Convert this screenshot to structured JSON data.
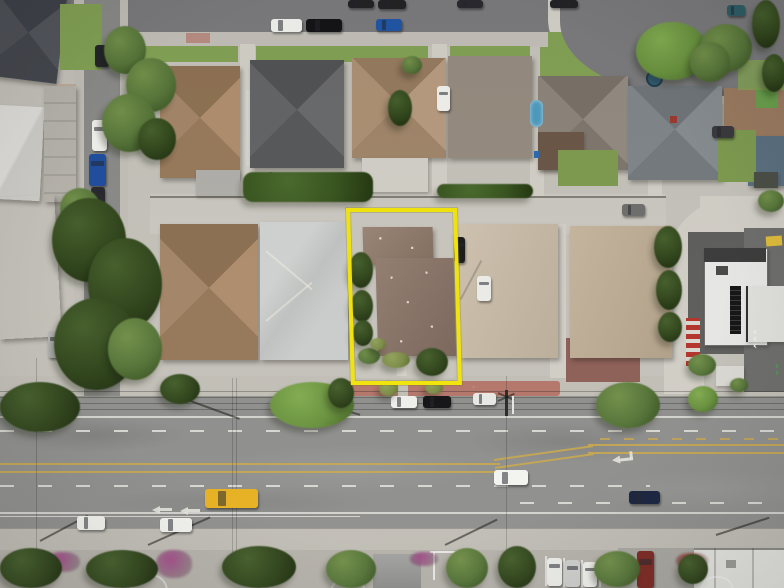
{
  "scene": {
    "description": "Aerial drone photograph of a suburban residential block; a single-family parcel with a brown roof is outlined with a bright yellow rectangle; a wide four-lane boulevard with double yellow centerlines runs along the bottom, a smaller residential street runs along the top, and a side street with parked cars runs down the left edge.",
    "highlight_label": "subject-parcel-outline",
    "roads": {
      "top": "residential street with curb-parked cars",
      "left": "side street with parallel-parked cars",
      "bottom": "four-lane boulevard with center turn lane",
      "right": "rear alley curving around a commercial building"
    }
  },
  "palette": {
    "concrete": "#c6c3bb",
    "concrete_light": "#d3d0c8",
    "sidewalk": "#c3c0b8",
    "asphalt": "#90908e",
    "asphalt_dark": "#7b7b7d",
    "asphalt_lot": "#6e6e6c",
    "roof_slate": "#4c4f55",
    "roof_brown": "#a8896b",
    "roof_brown2": "#9b7b60",
    "roof_charcoal": "#616264",
    "roof_tan": "#b1957a",
    "roof_greige": "#978c80",
    "roof_warmgray": "#8d847b",
    "roof_shingle": "#80868a",
    "roof_lightgray": "#c9cbca",
    "roof_subject": "#8d7668",
    "roof_garage": "#937c6c",
    "roof_beige1": "#cbbda8",
    "roof_beige2": "#c2b096",
    "roof_white": "#e9e9e7",
    "grass": "#84a355",
    "lawn": "#7f9c50",
    "turf": "#69a04c",
    "lane_white": "#e6e4de",
    "lane_yellow": "#c9a94e",
    "highlight_yellow": "#f4e60b",
    "brick": "#b5786c",
    "maroon": "#8e6058",
    "pool": "#4f9cc0",
    "magenta": "#a23e86",
    "flower_red": "#9c2c24"
  },
  "vehicles": [
    {
      "x": 348,
      "y": 0,
      "w": 26,
      "h": 8,
      "c": "#232326",
      "d": "h",
      "n": "parked-car"
    },
    {
      "x": 378,
      "y": 0,
      "w": 28,
      "h": 9,
      "c": "#232326",
      "d": "h",
      "n": "parked-car"
    },
    {
      "x": 457,
      "y": 0,
      "w": 26,
      "h": 8,
      "c": "#2a2a2e",
      "d": "h",
      "n": "parked-car"
    },
    {
      "x": 550,
      "y": 0,
      "w": 28,
      "h": 8,
      "c": "#232326",
      "d": "h",
      "n": "parked-car"
    },
    {
      "x": 727,
      "y": 5,
      "w": 18,
      "h": 11,
      "c": "#2e5e66",
      "d": "h",
      "n": "parked-car"
    },
    {
      "x": 271,
      "y": 19,
      "w": 31,
      "h": 13,
      "c": "#f1f1ed",
      "d": "h",
      "n": "parked-car"
    },
    {
      "x": 306,
      "y": 19,
      "w": 36,
      "h": 13,
      "c": "#141417",
      "d": "h",
      "n": "parked-car"
    },
    {
      "x": 376,
      "y": 19,
      "w": 26,
      "h": 12,
      "c": "#2157a6",
      "d": "h",
      "n": "parked-truck"
    },
    {
      "x": 95,
      "y": 45,
      "w": 14,
      "h": 22,
      "c": "#26262a",
      "d": "v",
      "n": "parked-car"
    },
    {
      "x": 92,
      "y": 120,
      "w": 15,
      "h": 31,
      "c": "#f1f1ed",
      "d": "v",
      "n": "parked-car"
    },
    {
      "x": 89,
      "y": 154,
      "w": 17,
      "h": 32,
      "c": "#1f4fa0",
      "d": "v",
      "n": "parked-car"
    },
    {
      "x": 91,
      "y": 187,
      "w": 14,
      "h": 17,
      "c": "#2a2a2e",
      "d": "v",
      "n": "parked-car"
    },
    {
      "x": 48,
      "y": 331,
      "w": 13,
      "h": 27,
      "c": "#b9b9b7",
      "d": "v",
      "n": "parked-car"
    },
    {
      "x": 437,
      "y": 86,
      "w": 13,
      "h": 25,
      "c": "#f1f1ed",
      "d": "v",
      "n": "driveway-car"
    },
    {
      "x": 477,
      "y": 276,
      "w": 14,
      "h": 25,
      "c": "#eeeeea",
      "d": "v",
      "n": "driveway-car"
    },
    {
      "x": 454,
      "y": 237,
      "w": 11,
      "h": 26,
      "c": "#1a1a1d",
      "d": "v",
      "n": "driveway-car"
    },
    {
      "x": 622,
      "y": 204,
      "w": 23,
      "h": 12,
      "c": "#6f6f6d",
      "d": "h",
      "n": "alley-car"
    },
    {
      "x": 712,
      "y": 126,
      "w": 22,
      "h": 12,
      "c": "#3a3a3e",
      "d": "h",
      "n": "driveway-car"
    },
    {
      "x": 391,
      "y": 396,
      "w": 26,
      "h": 12,
      "c": "#f0f0ec",
      "d": "h",
      "n": "curb-parked-car"
    },
    {
      "x": 423,
      "y": 396,
      "w": 28,
      "h": 12,
      "c": "#141417",
      "d": "h",
      "n": "curb-parked-car"
    },
    {
      "x": 473,
      "y": 393,
      "w": 23,
      "h": 12,
      "c": "#e9e9e5",
      "d": "h",
      "n": "curb-parked-truck"
    },
    {
      "x": 205,
      "y": 489,
      "w": 53,
      "h": 19,
      "c": "#e8b122",
      "d": "h",
      "n": "yellow-truck"
    },
    {
      "x": 494,
      "y": 470,
      "w": 34,
      "h": 15,
      "c": "#f4f4f0",
      "d": "h",
      "n": "moving-car"
    },
    {
      "x": 629,
      "y": 491,
      "w": 31,
      "h": 13,
      "c": "#1a2440",
      "d": "h",
      "n": "moving-car"
    },
    {
      "x": 77,
      "y": 516,
      "w": 28,
      "h": 14,
      "c": "#f2f2ee",
      "d": "h",
      "n": "moving-car"
    },
    {
      "x": 160,
      "y": 518,
      "w": 32,
      "h": 14,
      "c": "#f2f2ee",
      "d": "h",
      "n": "moving-car"
    },
    {
      "x": 547,
      "y": 558,
      "w": 15,
      "h": 28,
      "c": "#eeeeea",
      "d": "v",
      "n": "lot-car"
    },
    {
      "x": 565,
      "y": 560,
      "w": 15,
      "h": 27,
      "c": "#cfcfcd",
      "d": "v",
      "n": "lot-car"
    },
    {
      "x": 583,
      "y": 562,
      "w": 14,
      "h": 25,
      "c": "#f0f0ec",
      "d": "v",
      "n": "lot-car"
    },
    {
      "x": 637,
      "y": 551,
      "w": 17,
      "h": 37,
      "c": "#7c2a22",
      "d": "v",
      "n": "red-truck"
    }
  ],
  "trees": [
    {
      "x": 104,
      "y": 26,
      "w": 42,
      "h": 48,
      "t": "mid"
    },
    {
      "x": 126,
      "y": 58,
      "w": 50,
      "h": 54,
      "t": "mid"
    },
    {
      "x": 102,
      "y": 94,
      "w": 54,
      "h": 58,
      "t": "mid"
    },
    {
      "x": 138,
      "y": 118,
      "w": 38,
      "h": 42,
      "t": "dark"
    },
    {
      "x": 388,
      "y": 90,
      "w": 24,
      "h": 36,
      "t": "dark"
    },
    {
      "x": 402,
      "y": 56,
      "w": 20,
      "h": 18,
      "t": "mid"
    },
    {
      "x": 636,
      "y": 22,
      "w": 72,
      "h": 58,
      "t": "bright"
    },
    {
      "x": 700,
      "y": 24,
      "w": 52,
      "h": 48,
      "t": "mid"
    },
    {
      "x": 752,
      "y": 0,
      "w": 28,
      "h": 48,
      "t": "dark"
    },
    {
      "x": 762,
      "y": 54,
      "w": 24,
      "h": 38,
      "t": "dark"
    },
    {
      "x": 690,
      "y": 42,
      "w": 40,
      "h": 40,
      "t": "mid"
    },
    {
      "x": 60,
      "y": 188,
      "w": 40,
      "h": 40,
      "t": "mid"
    },
    {
      "x": 52,
      "y": 198,
      "w": 74,
      "h": 84,
      "t": "dark"
    },
    {
      "x": 88,
      "y": 238,
      "w": 74,
      "h": 92,
      "t": "dark"
    },
    {
      "x": 54,
      "y": 298,
      "w": 84,
      "h": 92,
      "t": "dark"
    },
    {
      "x": 108,
      "y": 318,
      "w": 54,
      "h": 62,
      "t": "mid"
    },
    {
      "x": 243,
      "y": 172,
      "w": 130,
      "h": 30,
      "t": "hedge"
    },
    {
      "x": 437,
      "y": 184,
      "w": 96,
      "h": 14,
      "t": "hedge"
    },
    {
      "x": 654,
      "y": 226,
      "w": 28,
      "h": 42,
      "t": "dark"
    },
    {
      "x": 656,
      "y": 270,
      "w": 26,
      "h": 40,
      "t": "dark"
    },
    {
      "x": 658,
      "y": 312,
      "w": 24,
      "h": 30,
      "t": "dark"
    },
    {
      "x": 688,
      "y": 354,
      "w": 28,
      "h": 22,
      "t": "mid"
    },
    {
      "x": 758,
      "y": 190,
      "w": 26,
      "h": 22,
      "t": "mid"
    },
    {
      "x": 349,
      "y": 252,
      "w": 24,
      "h": 36,
      "t": "dark"
    },
    {
      "x": 351,
      "y": 290,
      "w": 22,
      "h": 32,
      "t": "dark"
    },
    {
      "x": 353,
      "y": 320,
      "w": 20,
      "h": 26,
      "t": "dark"
    },
    {
      "x": 358,
      "y": 348,
      "w": 22,
      "h": 16,
      "t": "mid"
    },
    {
      "x": 382,
      "y": 352,
      "w": 28,
      "h": 16,
      "t": "olive"
    },
    {
      "x": 416,
      "y": 348,
      "w": 32,
      "h": 28,
      "t": "dark"
    },
    {
      "x": 370,
      "y": 338,
      "w": 16,
      "h": 12,
      "t": "olive"
    },
    {
      "x": 0,
      "y": 382,
      "w": 80,
      "h": 50,
      "t": "dark"
    },
    {
      "x": 160,
      "y": 374,
      "w": 40,
      "h": 30,
      "t": "dark"
    },
    {
      "x": 270,
      "y": 382,
      "w": 84,
      "h": 46,
      "t": "bright"
    },
    {
      "x": 328,
      "y": 378,
      "w": 26,
      "h": 30,
      "t": "dark"
    },
    {
      "x": 379,
      "y": 381,
      "w": 19,
      "h": 15,
      "t": "olive"
    },
    {
      "x": 425,
      "y": 381,
      "w": 18,
      "h": 13,
      "t": "olive"
    },
    {
      "x": 596,
      "y": 382,
      "w": 64,
      "h": 46,
      "t": "mid"
    },
    {
      "x": 688,
      "y": 386,
      "w": 30,
      "h": 26,
      "t": "bright"
    },
    {
      "x": 0,
      "y": 548,
      "w": 62,
      "h": 40,
      "t": "dark"
    },
    {
      "x": 86,
      "y": 550,
      "w": 72,
      "h": 38,
      "t": "dark"
    },
    {
      "x": 222,
      "y": 546,
      "w": 74,
      "h": 42,
      "t": "dark"
    },
    {
      "x": 326,
      "y": 550,
      "w": 50,
      "h": 38,
      "t": "mid"
    },
    {
      "x": 446,
      "y": 548,
      "w": 42,
      "h": 40,
      "t": "mid"
    },
    {
      "x": 498,
      "y": 546,
      "w": 38,
      "h": 42,
      "t": "dark"
    },
    {
      "x": 594,
      "y": 551,
      "w": 46,
      "h": 36,
      "t": "mid"
    },
    {
      "x": 678,
      "y": 554,
      "w": 30,
      "h": 30,
      "t": "dark"
    },
    {
      "x": 730,
      "y": 378,
      "w": 18,
      "h": 14,
      "t": "mid"
    }
  ],
  "flowers": [
    {
      "x": 46,
      "y": 552,
      "w": 34,
      "h": 20,
      "c": "#a23e86"
    },
    {
      "x": 90,
      "y": 556,
      "w": 60,
      "h": 26,
      "c": "#a23e86"
    },
    {
      "x": 156,
      "y": 550,
      "w": 36,
      "h": 28,
      "c": "#a23e86"
    },
    {
      "x": 410,
      "y": 552,
      "w": 28,
      "h": 14,
      "c": "#a23e86"
    },
    {
      "x": 246,
      "y": 554,
      "w": 48,
      "h": 20,
      "c": "#9c2c24"
    },
    {
      "x": 676,
      "y": 553,
      "w": 32,
      "h": 16,
      "c": "#9c2c24"
    }
  ],
  "markings": {
    "center_line": "double-yellow with left-turn pocket",
    "lane_lines": "white solid edge lines and white skip dashes",
    "turn_arrow": "white left-turn arrow",
    "straight_arrows": 2,
    "white_chevrons": 3,
    "green_chevrons": 2
  }
}
